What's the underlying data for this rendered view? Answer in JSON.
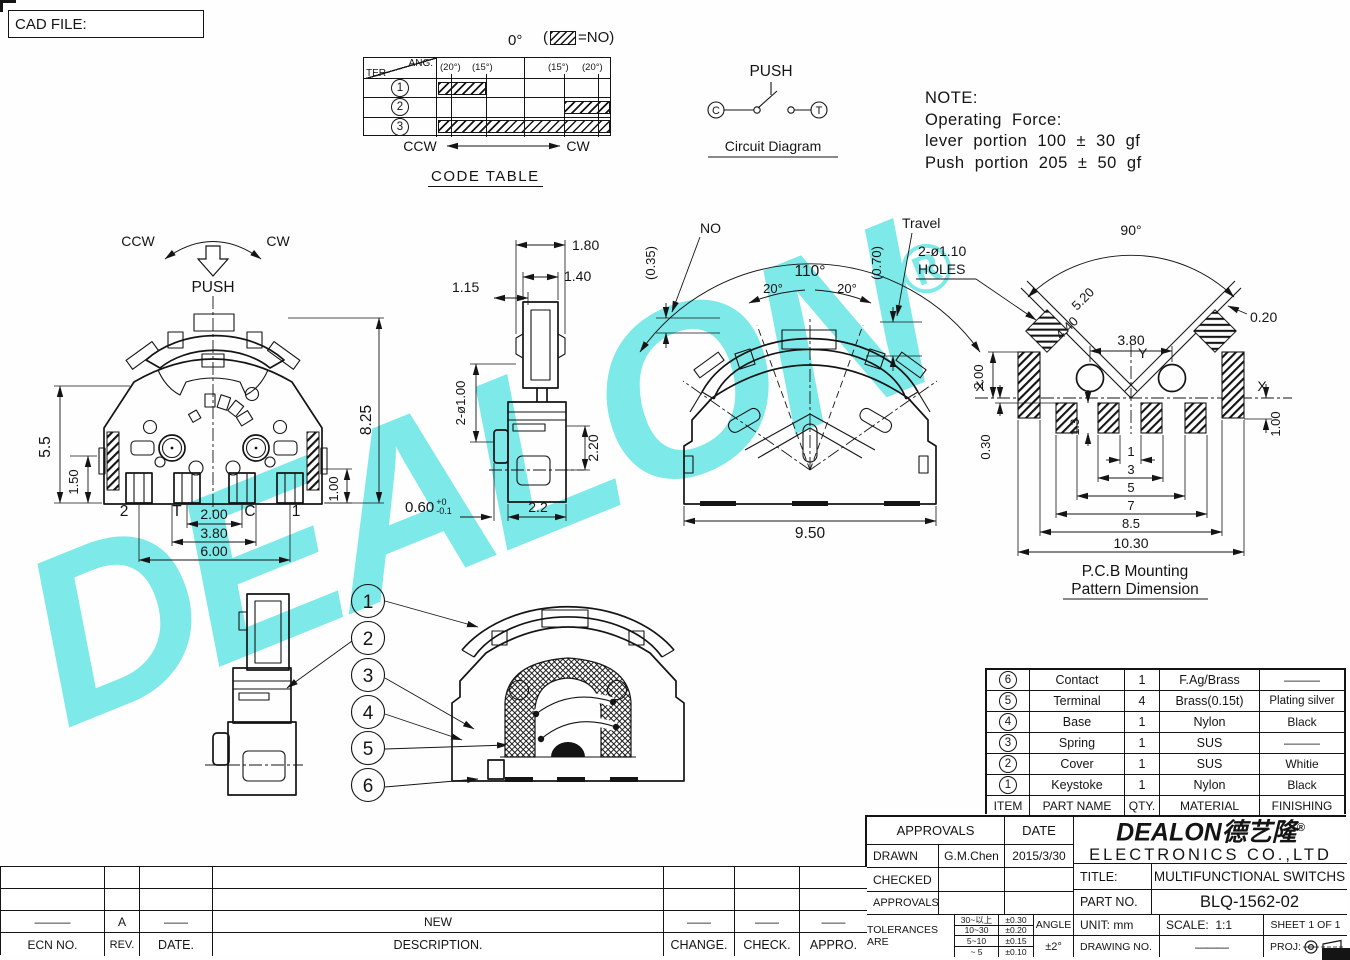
{
  "sheet": {
    "cad_file_label": "CAD FILE:",
    "watermark": "DEALON",
    "watermark_reg": "®",
    "watermark_color": "#7ee9e9"
  },
  "code_table": {
    "zero_label": "0°",
    "legend_open": "(",
    "legend_eq": "=NO",
    "legend_close": ")",
    "header_ter": "TER",
    "header_ang": "ANG.",
    "angle_labels": [
      "(20°)",
      "(15°)",
      "(15°)",
      "(20°)"
    ],
    "row_items": [
      "1",
      "2",
      "3"
    ],
    "ccw": "CCW",
    "cw": "CW",
    "title": "CODE TABLE"
  },
  "circuit": {
    "push_label": "PUSH",
    "left_terminal": "C",
    "right_terminal": "T",
    "title": "Circuit Diagram"
  },
  "note": {
    "line1": "NOTE:",
    "line2": "Operating Force:",
    "line3": "lever portion 100 ± 30 gf",
    "line4": "Push portion 205 ± 50 gf"
  },
  "front_view": {
    "ccw": "CCW",
    "cw": "CW",
    "push": "PUSH",
    "dim_height": "8.25",
    "dim_body_height": "5.5",
    "dim_clip": "1.50",
    "dim_terminal": "1.00",
    "dim_tc": "2.00",
    "dim_t2": "3.80",
    "dim_width": "6.00",
    "terminals": [
      "2",
      "T",
      "C",
      "1"
    ]
  },
  "side_view": {
    "dim_stem_top": "1.80",
    "dim_stem": "1.40",
    "dim_lever": "1.15",
    "dim_holes": "2-ø1.00",
    "dim_body_h": "2.20",
    "dim_body_w": "2.2",
    "dim_tab": "0.60",
    "dim_tab_tol_up": "+0",
    "dim_tab_tol_dn": "-0.1"
  },
  "rotation_view": {
    "no_label": "NO",
    "no_dim": "(0.35)",
    "travel_label": "Travel",
    "travel_dim": "(0.70)",
    "dim_total_angle": "110°",
    "dim_left_angle": "20°",
    "dim_right_angle": "20°",
    "dim_width": "9.50"
  },
  "pcb_view": {
    "dim_angle": "90°",
    "holes_line1": "2-ø1.10",
    "holes_line2": "HOLES",
    "dim_diag1": "5.20",
    "dim_diag2": "4.40",
    "dim_holes_span": "3.80",
    "dim_pad_thk": "0.20",
    "axis_y": "Y",
    "axis_x_left": "X",
    "axis_x_right": "X",
    "dim_above": "2.00",
    "dim_below": "0.30",
    "dim_pad_h": "1.3",
    "dim_p1": "1",
    "dim_p3": "3",
    "dim_p5": "5",
    "dim_p7": "7",
    "dim_p85": "8.5",
    "dim_p103": "10.30",
    "dim_side_pad": "1.00",
    "title1": "P.C.B Mounting",
    "title2": "Pattern Dimension"
  },
  "section_view": {
    "callouts": [
      "1",
      "2",
      "3",
      "4",
      "5",
      "6"
    ]
  },
  "parts_table": {
    "rows": [
      {
        "item": "6",
        "part": "Contact",
        "qty": "1",
        "material": "F.Ag/Brass",
        "finishing": "———"
      },
      {
        "item": "5",
        "part": "Terminal",
        "qty": "4",
        "material": "Brass(0.15t)",
        "finishing": "Plating silver"
      },
      {
        "item": "4",
        "part": "Base",
        "qty": "1",
        "material": "Nylon",
        "finishing": "Black"
      },
      {
        "item": "3",
        "part": "Spring",
        "qty": "1",
        "material": "SUS",
        "finishing": "———"
      },
      {
        "item": "2",
        "part": "Cover",
        "qty": "1",
        "material": "SUS",
        "finishing": "Whitie"
      },
      {
        "item": "1",
        "part": "Keystoke",
        "qty": "1",
        "material": "Nylon",
        "finishing": "Black"
      }
    ],
    "headers": {
      "item": "ITEM",
      "part": "PART NAME",
      "qty": "QTY.",
      "material": "MATERIAL",
      "finishing": "FINISHING"
    }
  },
  "title_block": {
    "approvals_label": "APPROVALS",
    "date_label": "DATE",
    "drawn_label": "DRAWN",
    "drawn_name": "G.M.Chen",
    "drawn_date": "2015/3/30",
    "checked_label": "CHECKED",
    "approvals2_label": "APPROVALS",
    "tolerances_label": "TOLERANCES ARE",
    "tolerance_rows": [
      {
        "range": "30~以上",
        "value": "±0.30"
      },
      {
        "range": "10~30",
        "value": "±0.20"
      },
      {
        "range": "5~10",
        "value": "±0.15"
      },
      {
        "range": "~ 5",
        "value": "±0.10"
      }
    ],
    "angle_label": "ANGLE",
    "angle_value": "±2°",
    "logo_text": "DEALON",
    "logo_cjk": "德艺隆",
    "logo_reg": "®",
    "company_name": "ELECTRONICS CO.,LTD",
    "title_label": "TITLE:",
    "title_value": "MULTIFUNCTIONAL SWITCHS",
    "part_label": "PART NO.",
    "part_value": "BLQ-1562-02",
    "unit_label": "UNIT:",
    "unit_value": "mm",
    "scale_label": "SCALE:",
    "scale_value": "1:1",
    "sheet_label": "SHEET",
    "sheet_value": "1 OF 1",
    "drawing_label": "DRAWING NO.",
    "drawing_value": "———",
    "proj_label": "PROJ:"
  },
  "revision_table": {
    "row": {
      "ecn": "———",
      "rev": "A",
      "date": "——",
      "description": "NEW",
      "change": "——",
      "check": "——",
      "appro": "——"
    },
    "headers": {
      "ecn": "ECN NO.",
      "rev": "REV.",
      "date": "DATE.",
      "description": "DESCRIPTION.",
      "change": "CHANGE.",
      "check": "CHECK.",
      "appro": "APPRO."
    }
  }
}
